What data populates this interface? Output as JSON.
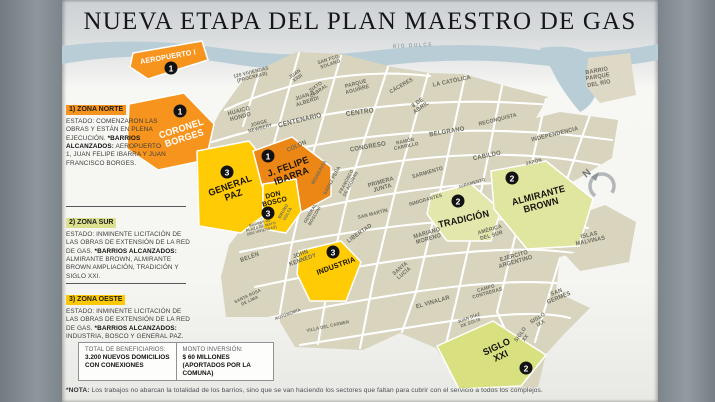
{
  "title": "NUEVA ETAPA DEL PLAN MAESTRO DE GAS",
  "zones": [
    {
      "heading": "1) ZONA NORTE",
      "estado": "ESTADO: COMENZARON LAS OBRAS Y ESTÁN EN PLENA EJECUCIÓN.",
      "barrios_label": "*BARRIOS ALCANZADOS:",
      "barrios": "AEROPUERTO 1, JUAN FELIPE IBARRA Y JUAN FRANCISCO BORGES.",
      "highlight": "#F6941D"
    },
    {
      "heading": "2) ZONA SUR",
      "estado": "ESTADO: INMINENTE LICITACIÓN DE LAS OBRAS DE EXTENSIÓN DE LA RED DE GAS.",
      "barrios_label": "*BARRIOS ALCANZADOS:",
      "barrios": "ALMIRANTE BROWN, ALMIRANTE BROWN AMPLIACIÓN, TRADICIÓN Y SIGLO XXI.",
      "highlight": "#DCE18F"
    },
    {
      "heading": "3) ZONA OESTE",
      "estado": "ESTADO: INMINENTE LICITACIÓN DE LAS OBRAS DE EXTENSIÓN DE LA RED DE GAS.",
      "barrios_label": "*BARRIOS ALCANZADOS:",
      "barrios": "INDUSTRIA, BOSCO Y GENERAL PAZ.",
      "highlight": "#FDC905"
    }
  ],
  "stats": {
    "beneficiarios_label": "TOTAL DE BENEFICIARIOS:",
    "beneficiarios_value": "3.200 NUEVOS DOMICILIOS CON CONEXIONES",
    "inversion_label": "MONTO INVERSIÓN:",
    "inversion_value": "$ 60 MILLONES (APORTADOS POR LA COMUNA)"
  },
  "note_label": "*NOTA:",
  "note_text": "Los trabajos no abarcan la totalidad de los barrios, sino que se van haciendo los sectores que faltan para cubrir con el servicio a todos los complejos.",
  "map": {
    "compass_letter": "N",
    "zone_labels": [
      {
        "label": "AEROPUERTO I",
        "x": 168,
        "y": 57,
        "r": -10,
        "fs": 7.5,
        "c": "#FFFFFF"
      },
      {
        "label": "CORONEL\nBORGES",
        "x": 183,
        "y": 134,
        "r": -18,
        "fs": 9.5,
        "c": "#FFFFFF"
      },
      {
        "label": "J. FELIPE\nIBARRA",
        "x": 290,
        "y": 172,
        "r": -20,
        "fs": 9.5,
        "c": "#17130e"
      },
      {
        "label": "GENERAL\nPAZ",
        "x": 232,
        "y": 191,
        "r": -20,
        "fs": 9.5,
        "c": "#17130e"
      },
      {
        "label": "DON\nBOSCO",
        "x": 274,
        "y": 199,
        "r": -14,
        "fs": 7,
        "c": "#17130e"
      },
      {
        "label": "INDUSTRIA",
        "x": 336,
        "y": 266,
        "r": -20,
        "fs": 7.5,
        "c": "#17130e"
      },
      {
        "label": "TRADICIÓN",
        "x": 464,
        "y": 220,
        "r": -13,
        "fs": 9.5,
        "c": "#17130e"
      },
      {
        "label": "ALMIRANTE\nBROWN",
        "x": 540,
        "y": 201,
        "r": -15,
        "fs": 9.5,
        "c": "#17130e"
      },
      {
        "label": "SIGLO\nXXI",
        "x": 499,
        "y": 352,
        "r": -25,
        "fs": 9.5,
        "c": "#17130e"
      }
    ],
    "badges": [
      {
        "n": "1",
        "x": 171,
        "y": 68
      },
      {
        "n": "1",
        "x": 180,
        "y": 111
      },
      {
        "n": "1",
        "x": 268,
        "y": 156
      },
      {
        "n": "3",
        "x": 227,
        "y": 172
      },
      {
        "n": "3",
        "x": 268,
        "y": 213
      },
      {
        "n": "3",
        "x": 333,
        "y": 252
      },
      {
        "n": "2",
        "x": 458,
        "y": 201
      },
      {
        "n": "2",
        "x": 512,
        "y": 178
      },
      {
        "n": "2",
        "x": 526,
        "y": 368
      }
    ],
    "districts": [
      {
        "label": "RÍO DULCE",
        "x": 413,
        "y": 47,
        "r": -3,
        "fs": 5.5,
        "c": "#94a6af",
        "ls": 1.5
      },
      {
        "label": "120 VIVIENDAS\n(PROCREAR)",
        "x": 252,
        "y": 76,
        "r": -14,
        "fs": 5
      },
      {
        "label": "JUAN\nXXIII",
        "x": 297,
        "y": 77,
        "r": -35,
        "fs": 5
      },
      {
        "label": "SIXTO\nCABRAL",
        "x": 318,
        "y": 90,
        "r": -35,
        "fs": 5
      },
      {
        "label": "SAN FCO.\nSOLANO",
        "x": 330,
        "y": 63,
        "r": -18,
        "fs": 5
      },
      {
        "label": "PARQUE\nAGUIRRE",
        "x": 357,
        "y": 88,
        "r": -15,
        "fs": 5.5
      },
      {
        "label": "JUAN B.\nALBERDI",
        "x": 307,
        "y": 100,
        "r": -18,
        "fs": 5.5
      },
      {
        "label": "HUAICO\nHONDO",
        "x": 240,
        "y": 115,
        "r": -15,
        "fs": 6
      },
      {
        "label": "JORGE\nNEWBERY",
        "x": 260,
        "y": 127,
        "r": -15,
        "fs": 5
      },
      {
        "label": "CENTENARIO",
        "x": 300,
        "y": 121,
        "r": -14,
        "fs": 7
      },
      {
        "label": "CENTRO",
        "x": 360,
        "y": 113,
        "r": -8,
        "fs": 7
      },
      {
        "label": "CÁCERES",
        "x": 402,
        "y": 87,
        "r": -30,
        "fs": 5.5
      },
      {
        "label": "8 DE\nABRIL",
        "x": 420,
        "y": 106,
        "r": -35,
        "fs": 6
      },
      {
        "label": "BELGRANO",
        "x": 447,
        "y": 132,
        "r": -10,
        "fs": 6.5
      },
      {
        "label": "CONGRESO",
        "x": 368,
        "y": 147,
        "r": -10,
        "fs": 6.5
      },
      {
        "label": "RAMÓN\nCARRILLO",
        "x": 406,
        "y": 145,
        "r": -12,
        "fs": 5
      },
      {
        "label": "LA CATÓLICA",
        "x": 452,
        "y": 82,
        "r": -12,
        "fs": 6
      },
      {
        "label": "RECONQUISTA",
        "x": 498,
        "y": 121,
        "r": -14,
        "fs": 5.5
      },
      {
        "label": "INDEPENDENCIA",
        "x": 555,
        "y": 135,
        "r": -14,
        "fs": 6
      },
      {
        "label": "CABILDO",
        "x": 487,
        "y": 156,
        "r": -12,
        "fs": 6.5
      },
      {
        "label": "JAPÓN",
        "x": 534,
        "y": 163,
        "r": -14,
        "fs": 5
      },
      {
        "label": "BARRIO\nPARQUE\nDEL RÍO",
        "x": 598,
        "y": 78,
        "r": -10,
        "fs": 6
      },
      {
        "label": "COLÓN",
        "x": 297,
        "y": 147,
        "r": -24,
        "fs": 6
      },
      {
        "label": "RIVADAVIA",
        "x": 320,
        "y": 173,
        "r": -62,
        "fs": 5
      },
      {
        "label": "SAENZ PEÑA",
        "x": 333,
        "y": 181,
        "r": -62,
        "fs": 5
      },
      {
        "label": "FRANCISCO\nDE AGUIRRE",
        "x": 349,
        "y": 183,
        "r": -62,
        "fs": 4.5
      },
      {
        "label": "SARMIENTO",
        "x": 428,
        "y": 174,
        "r": -16,
        "fs": 5.5
      },
      {
        "label": "PRIMERA\nJUNTA",
        "x": 382,
        "y": 186,
        "r": -16,
        "fs": 6
      },
      {
        "label": "INMIGRANTES",
        "x": 426,
        "y": 201,
        "r": -16,
        "fs": 5
      },
      {
        "label": "JURAMENTO",
        "x": 472,
        "y": 184,
        "r": -16,
        "fs": 4.5
      },
      {
        "label": "SAN MARTÍN",
        "x": 373,
        "y": 215,
        "r": -14,
        "fs": 5
      },
      {
        "label": "LIBERTAD",
        "x": 360,
        "y": 234,
        "r": -35,
        "fs": 6
      },
      {
        "label": "MARIANO\nMORENO",
        "x": 428,
        "y": 237,
        "r": -16,
        "fs": 6
      },
      {
        "label": "AMÉRICA\nDEL SUR",
        "x": 491,
        "y": 234,
        "r": -16,
        "fs": 5.5
      },
      {
        "label": "EJÉRCITO\nARGENTINO",
        "x": 515,
        "y": 260,
        "r": -16,
        "fs": 6
      },
      {
        "label": "ISLAS\nMALVINAS",
        "x": 590,
        "y": 239,
        "r": -12,
        "fs": 6
      },
      {
        "label": "CAMPO\nCONTRERAS",
        "x": 487,
        "y": 292,
        "r": -16,
        "fs": 5
      },
      {
        "label": "SAN\nGERMÉS",
        "x": 558,
        "y": 296,
        "r": -22,
        "fs": 6
      },
      {
        "label": "SIGLO\nIXX",
        "x": 540,
        "y": 322,
        "r": -32,
        "fs": 5.5
      },
      {
        "label": "SIGLO\nXX",
        "x": 524,
        "y": 337,
        "r": -55,
        "fs": 5.5
      },
      {
        "label": "JUAN DÍAZ\nDE SOLÍS",
        "x": 470,
        "y": 321,
        "r": -20,
        "fs": 4.5
      },
      {
        "label": "EL VINALAR",
        "x": 433,
        "y": 303,
        "r": -16,
        "fs": 6
      },
      {
        "label": "SANTA\nLUCÍA",
        "x": 403,
        "y": 272,
        "r": -40,
        "fs": 5.5
      },
      {
        "label": "BELÉN",
        "x": 250,
        "y": 258,
        "r": -20,
        "fs": 6
      },
      {
        "label": "JOHN\nKENNEDY",
        "x": 302,
        "y": 258,
        "r": -20,
        "fs": 6
      },
      {
        "label": "SANTA ROSA\nDE LIMA",
        "x": 249,
        "y": 299,
        "r": -25,
        "fs": 4.5
      },
      {
        "label": "AUTONOMÍA",
        "x": 288,
        "y": 315,
        "r": -20,
        "fs": 4.5
      },
      {
        "label": "VILLA DEL CARMEN",
        "x": 328,
        "y": 327,
        "r": -12,
        "fs": 4.5
      },
      {
        "label": "MADRES DE\nPLAZA DE MAYO\n(600 VIVIENDAS)",
        "x": 261,
        "y": 227,
        "r": -15,
        "fs": 3.8
      },
      {
        "label": "BRUNO\nVOLTA",
        "x": 286,
        "y": 213,
        "r": -60,
        "fs": 4.5
      },
      {
        "label": "GENERAL\nMOSCONI",
        "x": 313,
        "y": 215,
        "r": -60,
        "fs": 4.5
      }
    ]
  },
  "colors": {
    "orange": "#F6941D",
    "dark_orange": "#EC8614",
    "yellow": "#FFCB05",
    "green": "#DCE18F",
    "green_light": "#E3E7AC",
    "beige": "#D8D4BE",
    "river": "#B9CDD7",
    "sidebar": "#858D94",
    "badge": "#121212"
  }
}
